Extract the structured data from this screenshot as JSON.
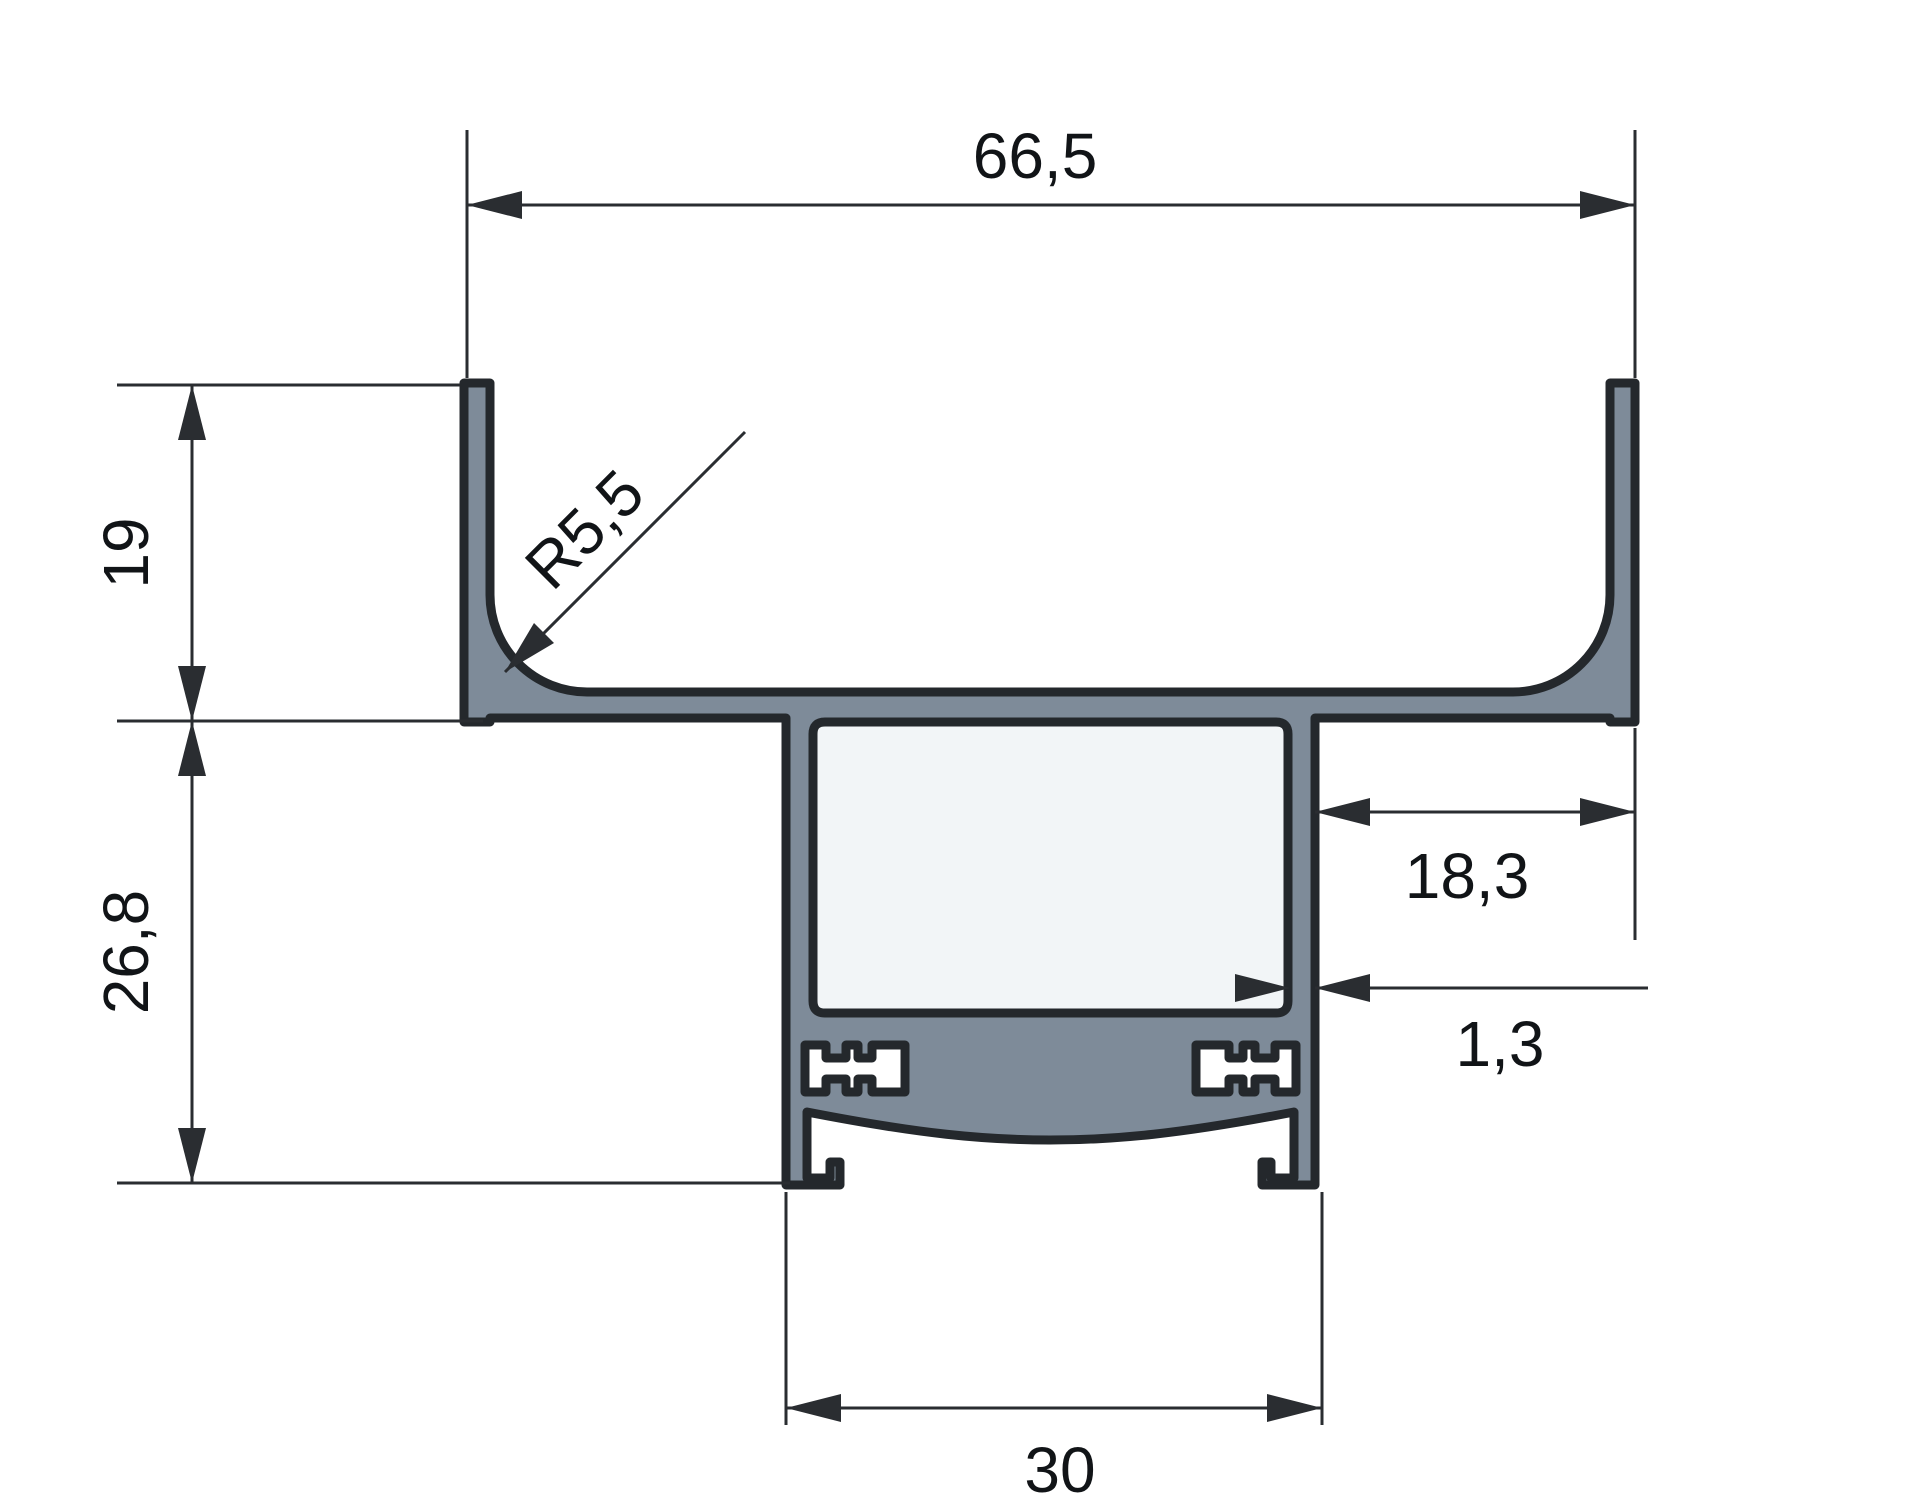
{
  "drawing": {
    "type": "technical-cross-section",
    "subject": "aluminum extrusion profile with dimension callouts"
  },
  "colors": {
    "background": "#ffffff",
    "profile_fill": "#7e8b99",
    "profile_outline": "#24282c",
    "inner_cavity_fill": "#f2f5f7",
    "dimension_color": "#2a2d31",
    "text_color": "#111417"
  },
  "dimensions": {
    "top_width": {
      "label": "66,5",
      "value": 66.5,
      "unit": "mm",
      "orientation": "horizontal"
    },
    "upper_wall_height": {
      "label": "19",
      "value": 19,
      "unit": "mm",
      "orientation": "vertical"
    },
    "lower_body_height": {
      "label": "26,8",
      "value": 26.8,
      "unit": "mm",
      "orientation": "vertical"
    },
    "fillet_radius": {
      "label": "R5,5",
      "value": 5.5,
      "unit": "mm",
      "orientation": "leader-45deg"
    },
    "right_flange_width": {
      "label": "18,3",
      "value": 18.3,
      "unit": "mm",
      "orientation": "horizontal"
    },
    "wall_thickness": {
      "label": "1,3",
      "value": 1.3,
      "unit": "mm",
      "orientation": "horizontal"
    },
    "bottom_width": {
      "label": "30",
      "value": 30,
      "unit": "mm",
      "orientation": "horizontal"
    }
  }
}
